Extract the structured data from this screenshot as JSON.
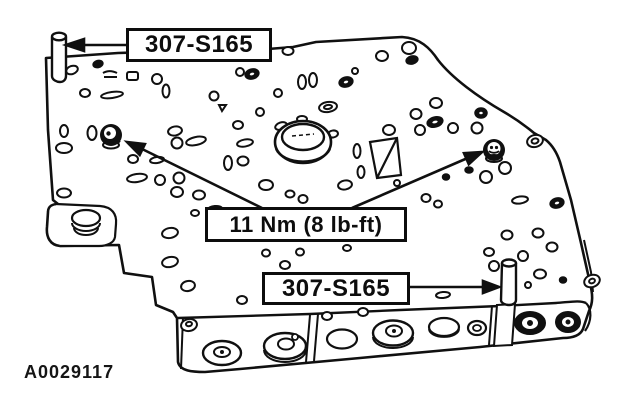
{
  "figure": {
    "id_code": "A0029117",
    "background_color": "#ffffff",
    "line_color": "#101010"
  },
  "callouts": {
    "top_part_label": "307-S165",
    "torque_label": "11 Nm (8 lb-ft)",
    "bottom_part_label": "307-S165"
  }
}
